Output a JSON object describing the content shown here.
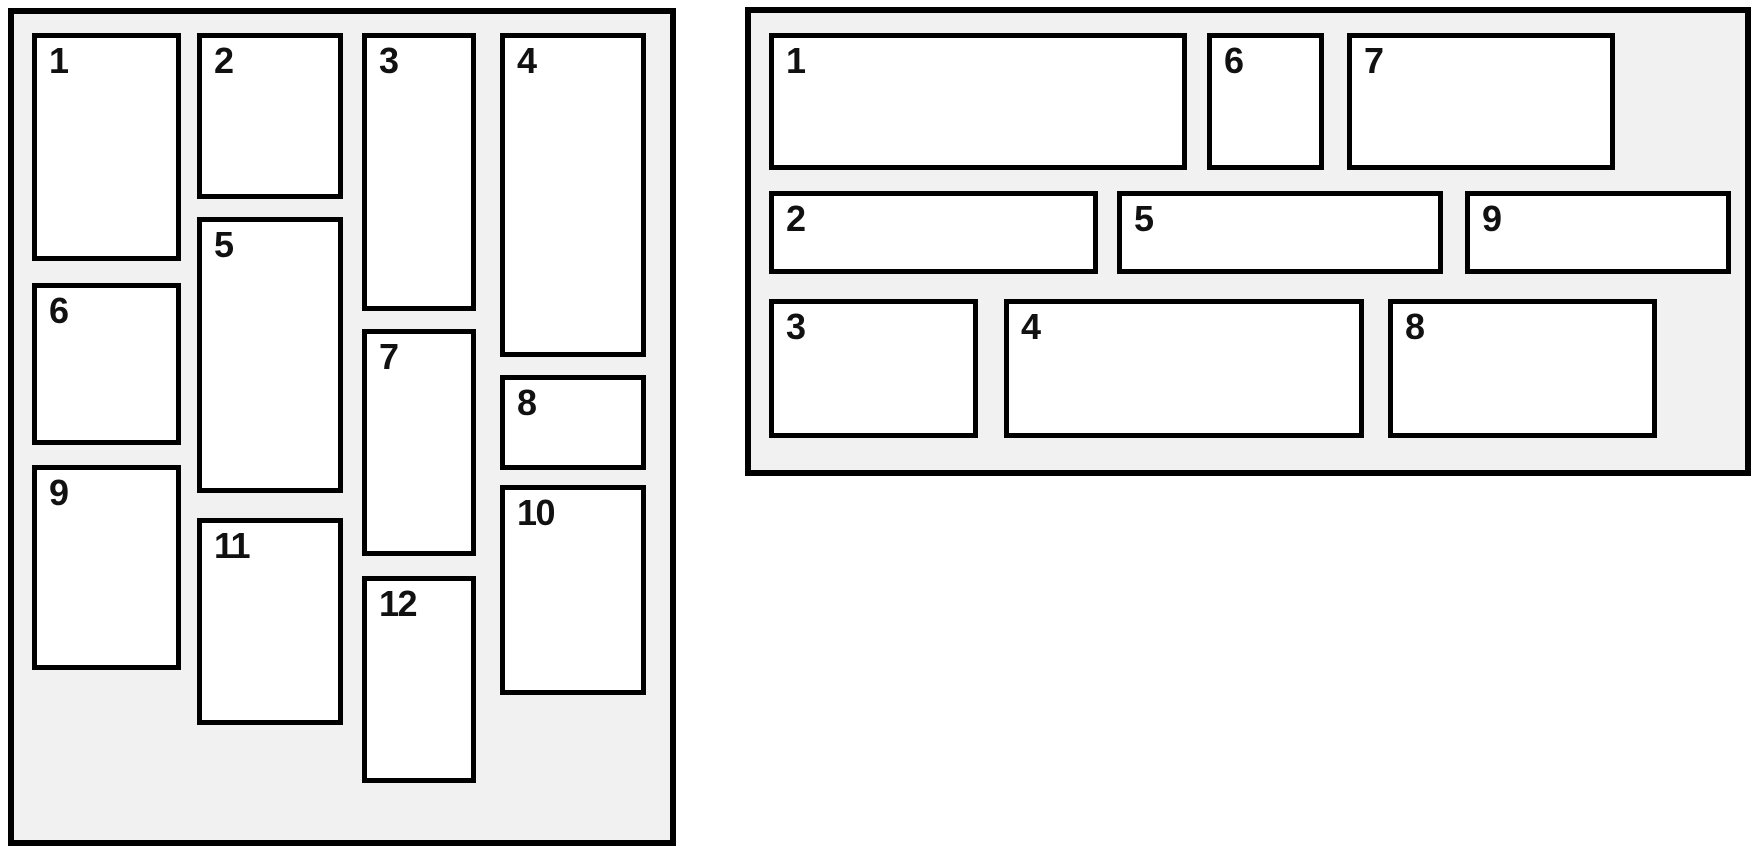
{
  "diagram": {
    "description": "Comparison of two layout mockups: masonry column-flow ordering (left) and row-flow ordering (right)",
    "colors": {
      "page_background": "#ffffff",
      "panel_background": "#f1f1f1",
      "panel_border": "#000000",
      "box_background": "#ffffff",
      "box_border": "#000000",
      "label_color": "#111111"
    }
  },
  "left_panel": {
    "boxes": [
      "1",
      "2",
      "3",
      "4",
      "5",
      "6",
      "7",
      "8",
      "9",
      "10",
      "11",
      "12"
    ]
  },
  "right_panel": {
    "boxes": [
      "1",
      "2",
      "3",
      "4",
      "5",
      "6",
      "7",
      "8",
      "9"
    ]
  }
}
